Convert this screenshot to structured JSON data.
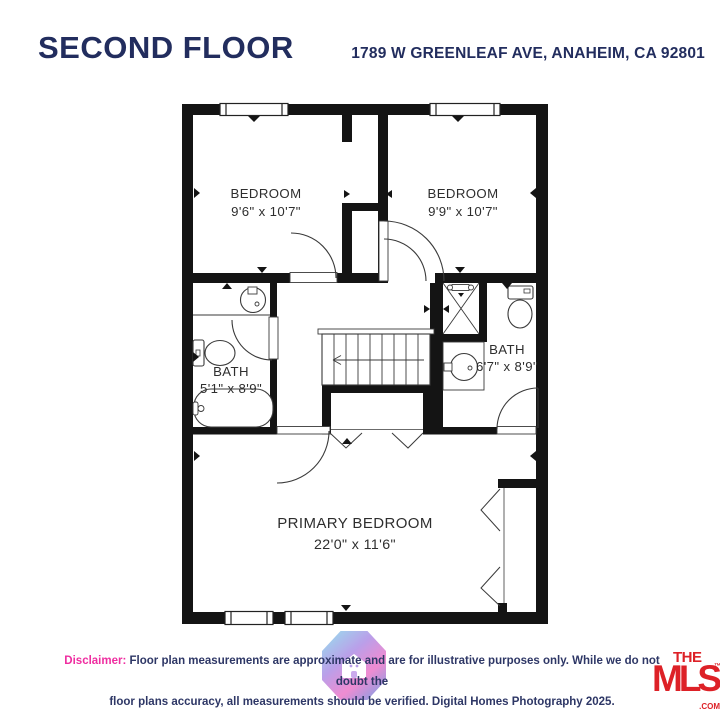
{
  "header": {
    "title": "SECOND FLOOR",
    "address": "1789 W GREENLEAF AVE, ANAHEIM, CA 92801"
  },
  "floor_plan": {
    "rooms": [
      {
        "name": "BEDROOM",
        "dimensions": "9'6\" x 10'7\""
      },
      {
        "name": "BEDROOM",
        "dimensions": "9'9\" x 10'7\""
      },
      {
        "name": "BATH",
        "dimensions": "5'1\" x 8'9\""
      },
      {
        "name": "BATH",
        "dimensions": "6'7\" x 8'9\""
      },
      {
        "name": "PRIMARY BEDROOM",
        "dimensions": "22'0\" x 11'6\""
      }
    ],
    "features": [
      "stairs",
      "windows",
      "swing-doors",
      "bifold-closet-doors",
      "bathtub",
      "toilets",
      "sinks",
      "shower"
    ]
  },
  "footer": {
    "disclaimer_label": "Disclaimer:",
    "disclaimer_line1": " Floor plan measurements are approximate and are for illustrative purposes only. While we do not doubt the",
    "disclaimer_line2": "floor plans accuracy, all measurements should be verified. Digital Homes Photography 2025.",
    "dhp_logo_icon": "house-icon",
    "mls": {
      "the": "THE",
      "mls": "MLS",
      "tm": "™",
      "com": ".COM"
    }
  },
  "colors": {
    "navy": "#222d5e",
    "disclaimer_pink": "#ef2da0",
    "mls_red": "#dd2127",
    "wall_black": "#141414"
  }
}
